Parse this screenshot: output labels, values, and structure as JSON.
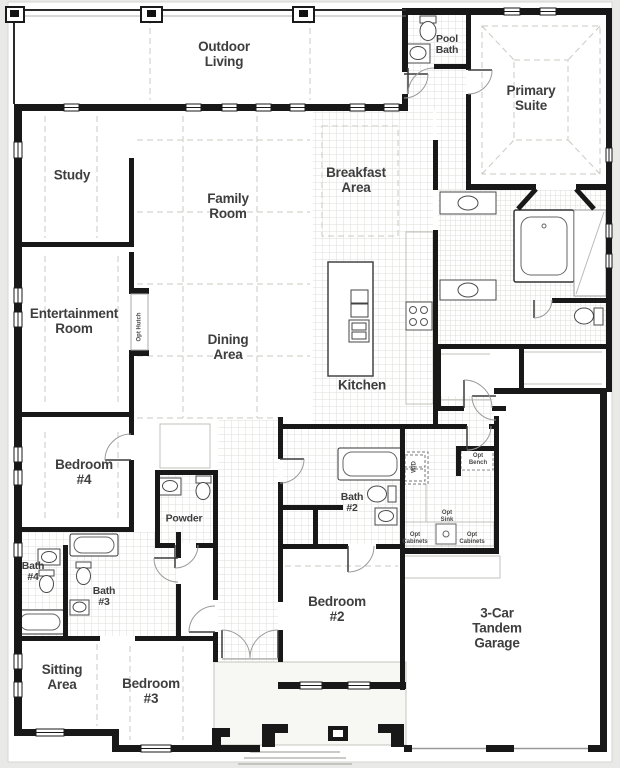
{
  "title": "Single-story home floor plan",
  "colors": {
    "background": "#e9e9e7",
    "paper": "#ffffff",
    "wall": "#181818",
    "label_text": "#3e3e3e",
    "tile_line": "#deded8",
    "dashed_line": "#c9c9c3"
  },
  "rooms": [
    {
      "name": "outdoor-living",
      "label": "Outdoor\nLiving",
      "x": 224,
      "y": 54,
      "size": "md"
    },
    {
      "name": "pool-bath",
      "label": "Pool\nBath",
      "x": 447,
      "y": 45,
      "size": "sm"
    },
    {
      "name": "primary-suite",
      "label": "Primary\nSuite",
      "x": 531,
      "y": 98,
      "size": "md"
    },
    {
      "name": "study",
      "label": "Study",
      "x": 72,
      "y": 175,
      "size": "md"
    },
    {
      "name": "family-room",
      "label": "Family\nRoom",
      "x": 228,
      "y": 206,
      "size": "md"
    },
    {
      "name": "breakfast-area",
      "label": "Breakfast\nArea",
      "x": 356,
      "y": 180,
      "size": "md"
    },
    {
      "name": "entertainment-room",
      "label": "Entertainment\nRoom",
      "x": 74,
      "y": 321,
      "size": "md"
    },
    {
      "name": "dining-area",
      "label": "Dining\nArea",
      "x": 228,
      "y": 347,
      "size": "md"
    },
    {
      "name": "kitchen",
      "label": "Kitchen",
      "x": 362,
      "y": 385,
      "size": "md"
    },
    {
      "name": "bedroom-4",
      "label": "Bedroom\n#4",
      "x": 84,
      "y": 472,
      "size": "md"
    },
    {
      "name": "powder",
      "label": "Powder",
      "x": 184,
      "y": 519,
      "size": "sm"
    },
    {
      "name": "bath-2",
      "label": "Bath\n#2",
      "x": 352,
      "y": 503,
      "size": "sm"
    },
    {
      "name": "bath-4",
      "label": "Bath\n#4",
      "x": 33,
      "y": 572,
      "size": "sm"
    },
    {
      "name": "bath-3",
      "label": "Bath\n#3",
      "x": 104,
      "y": 597,
      "size": "sm"
    },
    {
      "name": "bedroom-2",
      "label": "Bedroom\n#2",
      "x": 337,
      "y": 609,
      "size": "md"
    },
    {
      "name": "garage",
      "label": "3-Car\nTandem\nGarage",
      "x": 497,
      "y": 628,
      "size": "md"
    },
    {
      "name": "sitting-area",
      "label": "Sitting\nArea",
      "x": 62,
      "y": 677,
      "size": "md"
    },
    {
      "name": "bedroom-3",
      "label": "Bedroom\n#3",
      "x": 151,
      "y": 691,
      "size": "md"
    }
  ],
  "annotations": [
    {
      "name": "opt-hutch",
      "label": "Opt Hutch",
      "x": 140,
      "y": 327,
      "rotate": -90
    },
    {
      "name": "washer-dryer",
      "label": "W/D",
      "x": 415,
      "y": 467,
      "rotate": -90
    },
    {
      "name": "opt-bench",
      "label": "Opt\nBench",
      "x": 478,
      "y": 460,
      "rotate": 0
    },
    {
      "name": "opt-sink",
      "label": "Opt\nSink",
      "x": 447,
      "y": 517,
      "rotate": 0
    },
    {
      "name": "opt-cabinets-left",
      "label": "Opt\nCabinets",
      "x": 415,
      "y": 539,
      "rotate": 0
    },
    {
      "name": "opt-cabinets-right",
      "label": "Opt\nCabinets",
      "x": 472,
      "y": 539,
      "rotate": 0
    }
  ]
}
